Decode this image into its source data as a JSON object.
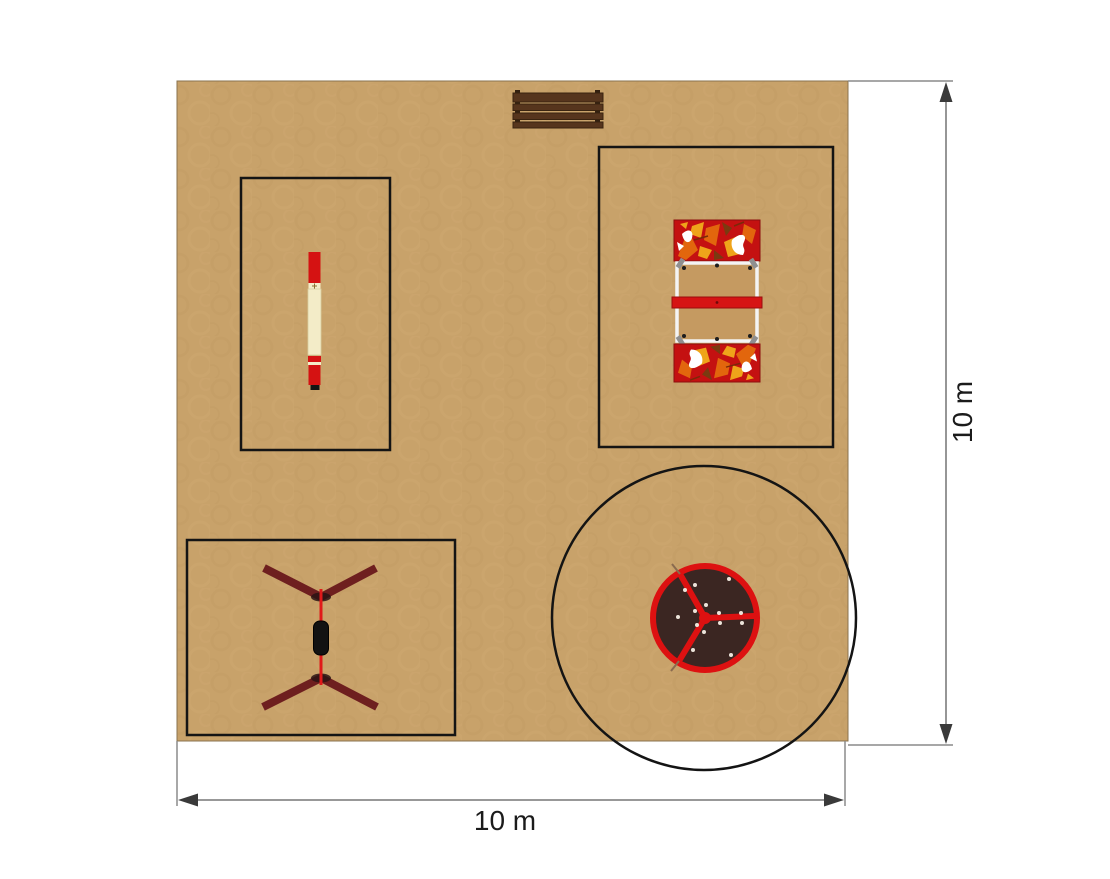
{
  "plan": {
    "type": "playground-layout-top-view",
    "dimension_labels": {
      "bottom": "10 m",
      "right": "10 m"
    },
    "equipment": [
      {
        "id": "bench",
        "name": "bench-icon"
      },
      {
        "id": "balance-beam",
        "name": "balance-beam-icon"
      },
      {
        "id": "play-structure",
        "name": "play-structure-icon"
      },
      {
        "id": "swing",
        "name": "swing-icon"
      },
      {
        "id": "carousel",
        "name": "carousel-icon"
      }
    ],
    "zones": [
      {
        "id": "balance-beam-zone",
        "shape": "rectangle"
      },
      {
        "id": "play-structure-zone",
        "shape": "rectangle"
      },
      {
        "id": "swing-zone",
        "shape": "rectangle"
      },
      {
        "id": "carousel-safety-zone",
        "shape": "circle"
      }
    ],
    "colors": {
      "background": "#ffffff",
      "sand": "#c8a26a",
      "sand_texture": "#bd975f",
      "zone_border": "#141414",
      "dimension_line": "#8a8a8a",
      "arrowhead": "#3a3a3a",
      "label_text": "#1b1b1b",
      "bench_wood": "#56351d",
      "bench_post": "#33200f",
      "beam_red": "#d51212",
      "beam_cream": "#f3ecc8",
      "beam_tip_black": "#141414",
      "panel_red": "#c41111",
      "panel_orange": "#e2660d",
      "panel_yellow": "#efa41a",
      "panel_white": "#ffffff",
      "structure_tan": "#c59a61",
      "structure_bar_red": "#d61414",
      "swing_maroon": "#6e1f1f",
      "swing_rope_red": "#e01919",
      "swing_seat_black": "#121212",
      "carousel_rim_red": "#dd1111",
      "carousel_deck_brown": "#3b2622",
      "carousel_dot_white": "#ece4da"
    }
  }
}
